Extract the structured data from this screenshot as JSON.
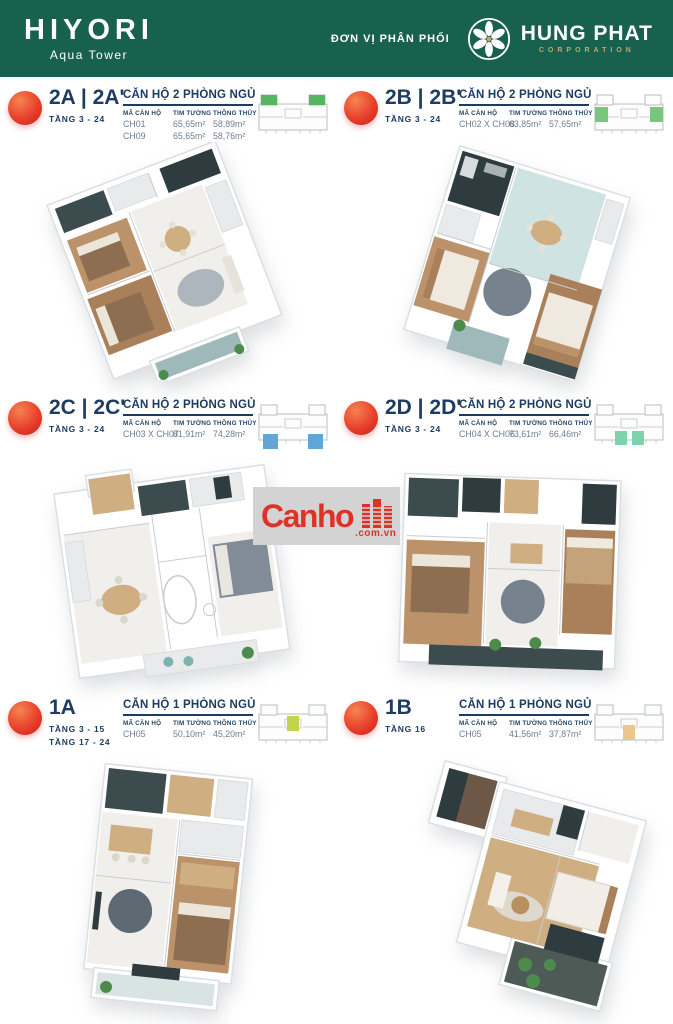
{
  "header": {
    "brand_title": "HIYORI",
    "brand_subtitle": "Aqua Tower",
    "distributor_label": "ĐƠN VỊ PHÂN PHỐI",
    "distributor_name": "HUNG PHAT",
    "distributor_sub": "CORPORATION",
    "bg_color": "#17614e"
  },
  "table_headers": {
    "col_code": "MÃ CĂN HỘ",
    "col_gross": "TIM TƯỜNG",
    "col_net": "THÔNG THỦY"
  },
  "units": [
    {
      "id": "2A",
      "title": "2A | 2A'",
      "floors": [
        "TẦNG 3 - 24"
      ],
      "table_title": "CĂN HỘ 2 PHÒNG NGỦ",
      "rows": [
        {
          "code": "CH01",
          "gross": "65,65m²",
          "net": "58,89m²"
        },
        {
          "code": "CH09",
          "gross": "65,65m²",
          "net": "58,76m²"
        }
      ],
      "keyplan_color": "#55b561"
    },
    {
      "id": "2B",
      "title": "2B | 2B'",
      "floors": [
        "TẦNG 3 - 24"
      ],
      "table_title": "CĂN HỘ 2 PHÒNG NGỦ",
      "rows": [
        {
          "code": "CH02 X CH08",
          "gross": "63,85m²",
          "net": "57,65m²"
        }
      ],
      "keyplan_color": "#79c77d"
    },
    {
      "id": "2C",
      "title": "2C | 2C'",
      "floors": [
        "TẦNG 3 - 24"
      ],
      "table_title": "CĂN HỘ 2 PHÒNG NGỦ",
      "rows": [
        {
          "code": "CH03 X CH07",
          "gross": "81,91m²",
          "net": "74,28m²"
        }
      ],
      "keyplan_color": "#61a6d6"
    },
    {
      "id": "2D",
      "title": "2D | 2D'",
      "floors": [
        "TẦNG 3 - 24"
      ],
      "table_title": "CĂN HỘ 2 PHÒNG NGỦ",
      "rows": [
        {
          "code": "CH04 X CH06",
          "gross": "73,61m²",
          "net": "66,46m²"
        }
      ],
      "keyplan_color": "#7dd3ab"
    },
    {
      "id": "1A",
      "title": "1A",
      "floors": [
        "TẦNG 3 - 15",
        "TẦNG 17 - 24"
      ],
      "table_title": "CĂN HỘ 1 PHÒNG NGỦ",
      "rows": [
        {
          "code": "CH05",
          "gross": "50,10m²",
          "net": "45,20m²"
        }
      ],
      "keyplan_color": "#c2d44b"
    },
    {
      "id": "1B",
      "title": "1B",
      "floors": [
        "TẦNG 16"
      ],
      "table_title": "CĂN HỘ 1 PHÒNG NGỦ",
      "rows": [
        {
          "code": "CH05",
          "gross": "41,56m²",
          "net": "37,87m²"
        }
      ],
      "keyplan_color": "#ebc78d"
    }
  ],
  "watermark": {
    "text": "Canho",
    "suffix": ".com.vn",
    "color": "#de3226"
  },
  "icons": {
    "hungphat_flower": "pinwheel-flower",
    "watermark_buildings": "building-towers",
    "keyplan": "floorplate-outline"
  },
  "colors": {
    "navy_text": "#1d3c64",
    "value_text": "#6e7d90",
    "badge_gradient": [
      "#f58450",
      "#c81e1a"
    ],
    "gold": "#c9a46a"
  }
}
